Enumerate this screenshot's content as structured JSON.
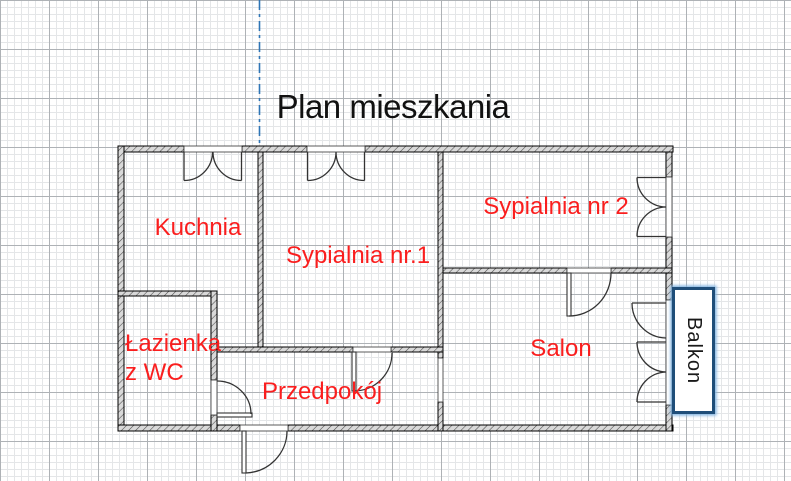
{
  "title": "Plan mieszkania",
  "rooms": {
    "kuchnia": {
      "label": "Kuchnia"
    },
    "sypialnia1": {
      "label": "Sypialnia nr.1"
    },
    "sypialnia2": {
      "label": "Sypialnia nr 2"
    },
    "lazienka": {
      "line1": "Łazienka",
      "line2": "z WC"
    },
    "przedpokoj": {
      "label": "Przedpokój"
    },
    "salon": {
      "label": "Salon"
    }
  },
  "balcony": {
    "label": "Balkon"
  },
  "colors": {
    "label-red": "#fa1e1e",
    "title-black": "#111111",
    "balcony-navy": "#1f4e79",
    "balcony-glow": "#7fb2e0",
    "guide-blue": "#2e75b6",
    "grid-minor": "#e4e6e8",
    "grid-major": "#aeb2b6",
    "wall-fill": "#d9d9d9",
    "wall-hatch": "#4a4a4a",
    "wall-edge": "#000000",
    "door-stroke": "#333333"
  }
}
